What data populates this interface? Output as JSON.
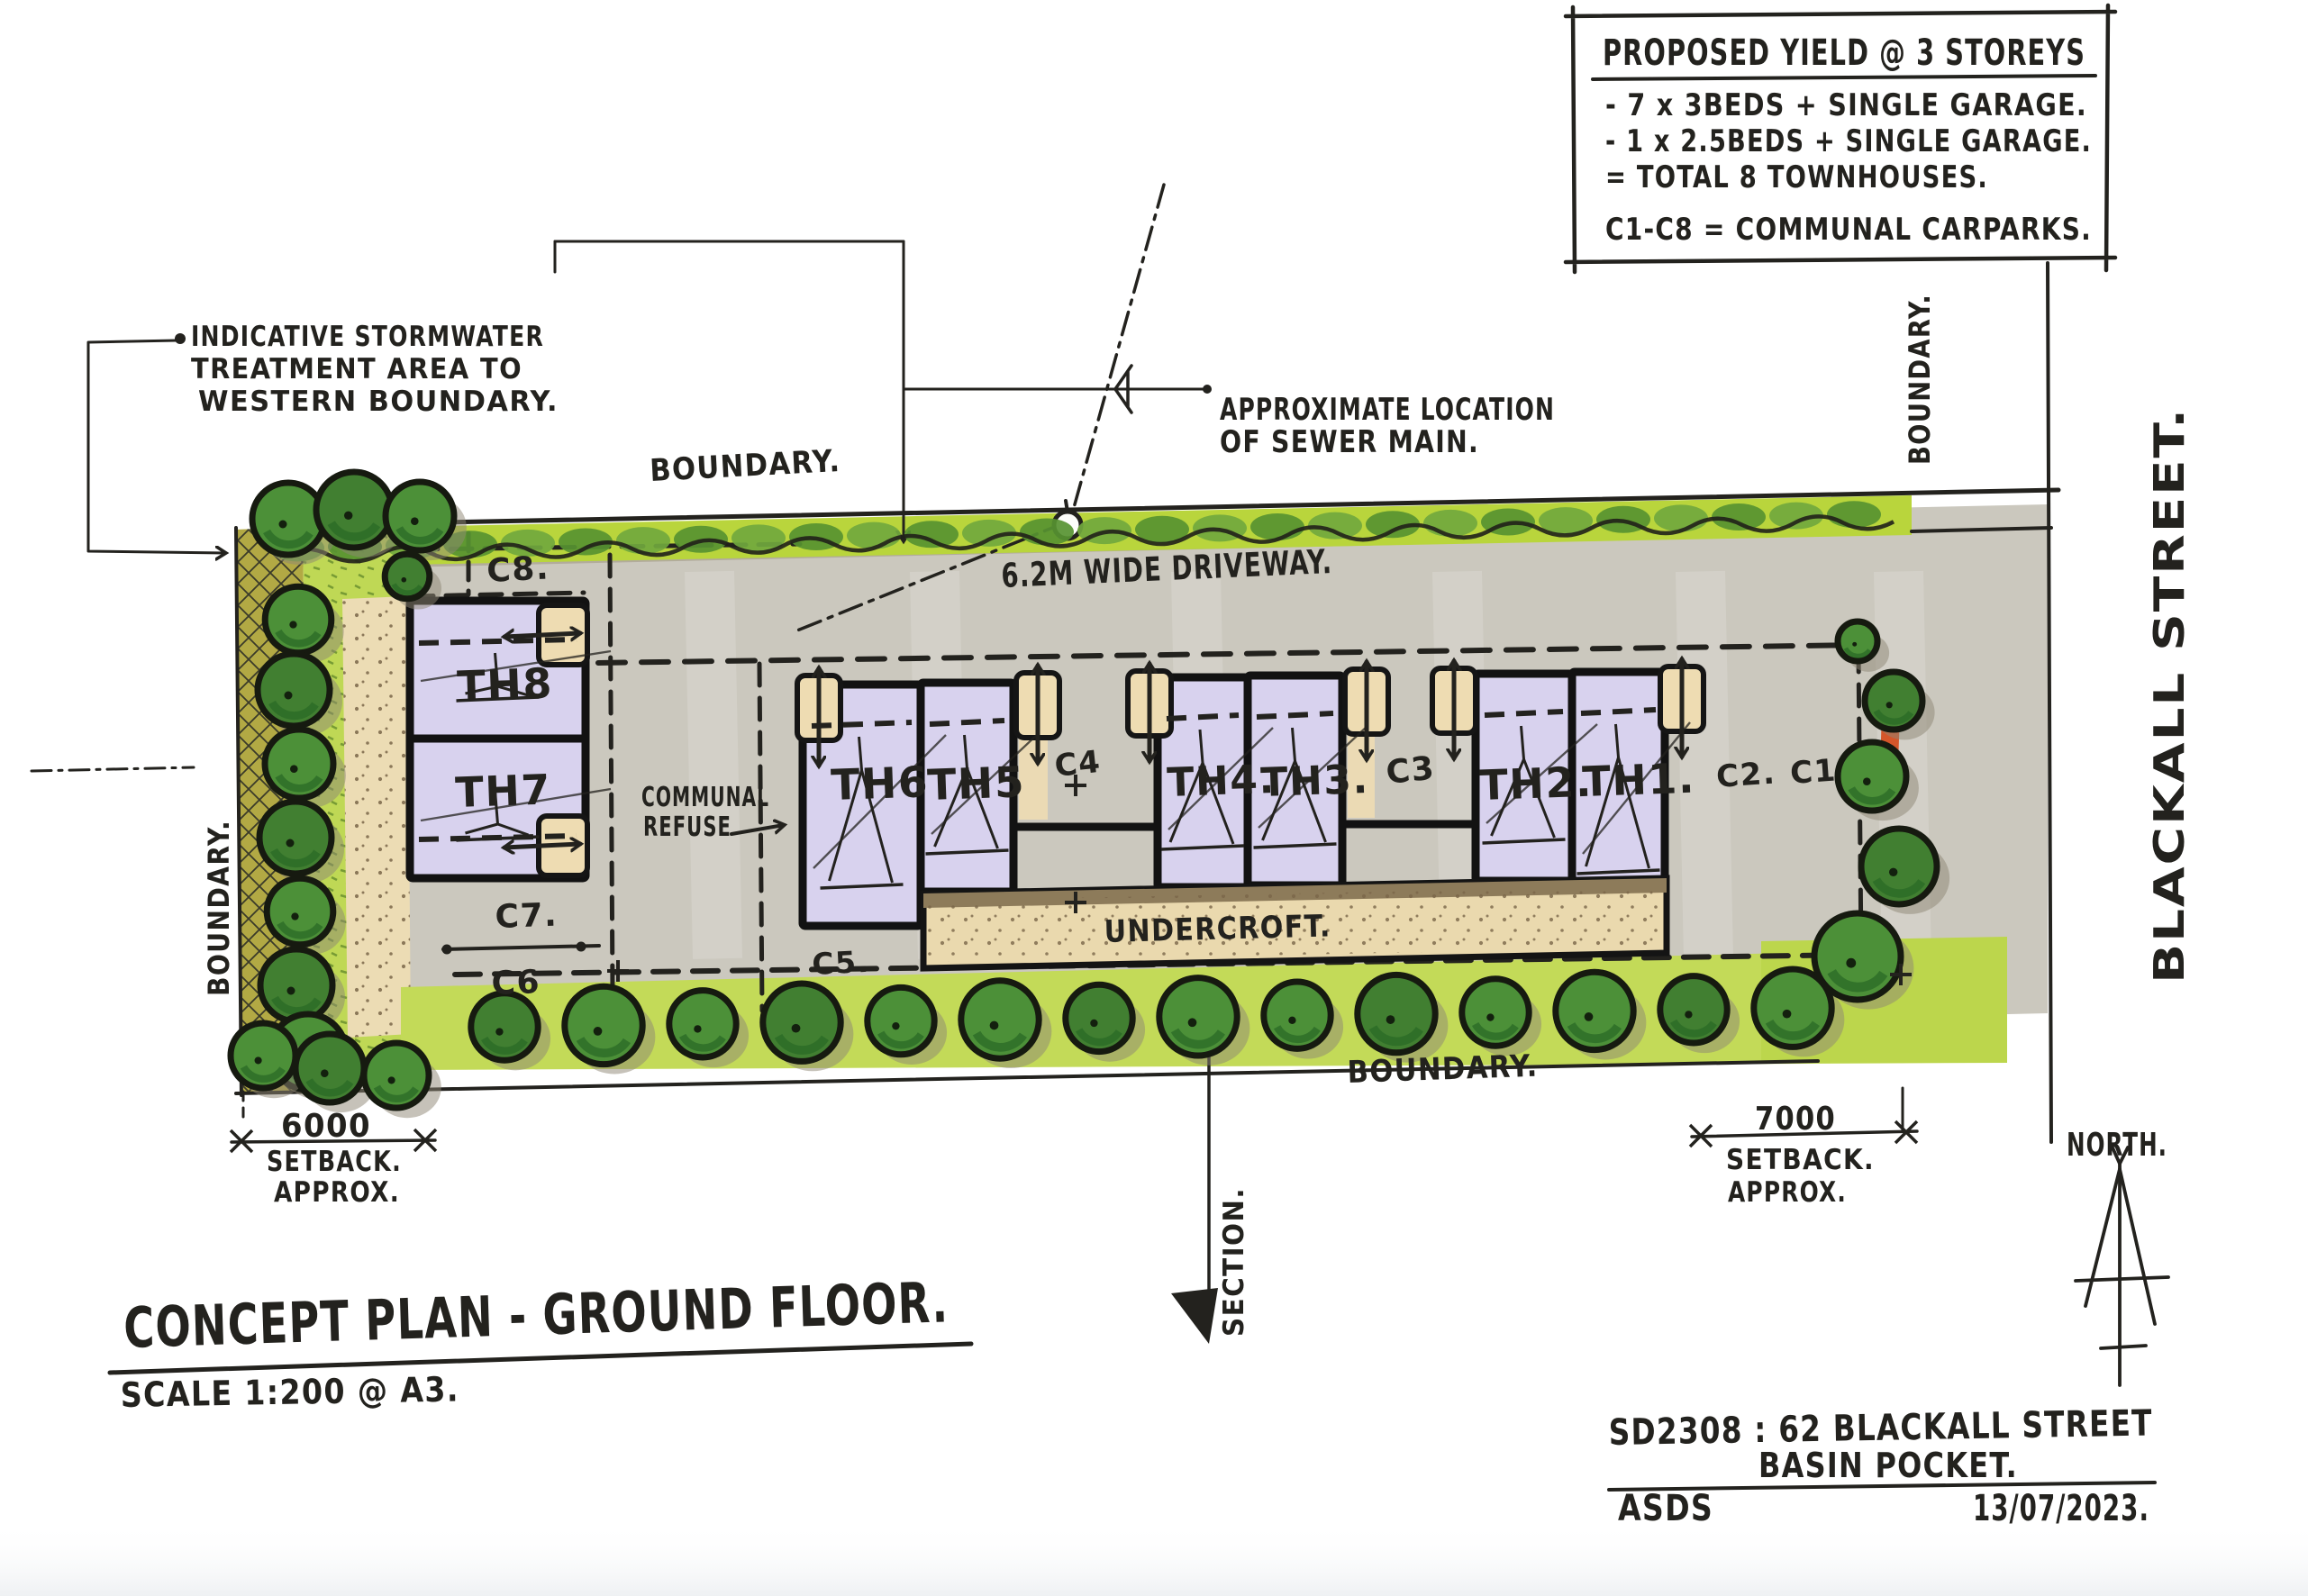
{
  "yield_box": {
    "title": "PROPOSED YIELD @ 3 STOREYS",
    "items": [
      "- 7 x 3BEDS + SINGLE GARAGE.",
      "- 1 x 2.5BEDS + SINGLE GARAGE.",
      "= TOTAL 8 TOWNHOUSES.",
      "C1-C8 = COMMUNAL CARPARKS."
    ]
  },
  "annotations": {
    "stormwater": {
      "lines": [
        "INDICATIVE STORMWATER",
        "TREATMENT AREA TO",
        "WESTERN BOUNDARY."
      ]
    },
    "sewer": {
      "lines": [
        "APPROXIMATE LOCATION",
        "OF SEWER MAIN."
      ]
    },
    "driveway": "6.2M WIDE DRIVEWAY.",
    "communal_refuse": {
      "lines": [
        "COMMUNAL",
        "REFUSE"
      ]
    },
    "undercroft": "UNDERCROFT.",
    "section": "SECTION.",
    "north": "NORTH."
  },
  "boundaries": {
    "top": "BOUNDARY.",
    "bottom": "BOUNDARY.",
    "west": "BOUNDARY.",
    "east": "BOUNDARY."
  },
  "street": {
    "name": "BLACKALL STREET."
  },
  "townhouses": [
    {
      "label": "TH8"
    },
    {
      "label": "TH7"
    },
    {
      "label": "TH6"
    },
    {
      "label": "TH5"
    },
    {
      "label": "TH4."
    },
    {
      "label": "TH3."
    },
    {
      "label": "TH2."
    },
    {
      "label": "TH1."
    }
  ],
  "carparks": {
    "c8": "C8.",
    "c7": "C7.",
    "c6": "C6",
    "c5": "C5.",
    "c4": "C4",
    "c3": "C3",
    "c2": "C2.",
    "c1": "C1"
  },
  "dimensions": {
    "west_setback": {
      "value": "6000",
      "label": "SETBACK.",
      "qualifier": "APPROX."
    },
    "east_setback": {
      "value": "7000",
      "label": "SETBACK.",
      "qualifier": "APPROX."
    }
  },
  "drawing_title": {
    "main": "CONCEPT PLAN - GROUND FLOOR.",
    "scale": "SCALE 1:200 @ A3."
  },
  "title_block": {
    "project": "SD2308 : 62 BLACKALL STREET",
    "locality": "BASIN POCKET.",
    "author": "ASDS",
    "date": "13/07/2023."
  },
  "colors": {
    "ink": "#23221e",
    "tree_green": "#4c9038",
    "hedge_lime": "#b9d53c",
    "lawn": "#c3da58",
    "driveway_grey": "#cbc8be",
    "building_lavender": "#d8d2ee",
    "garage_tan": "#eedcb2",
    "path_tan": "#ecdcb4",
    "hatch_olive": "#b2a944",
    "feature_red": "#d4562a"
  }
}
